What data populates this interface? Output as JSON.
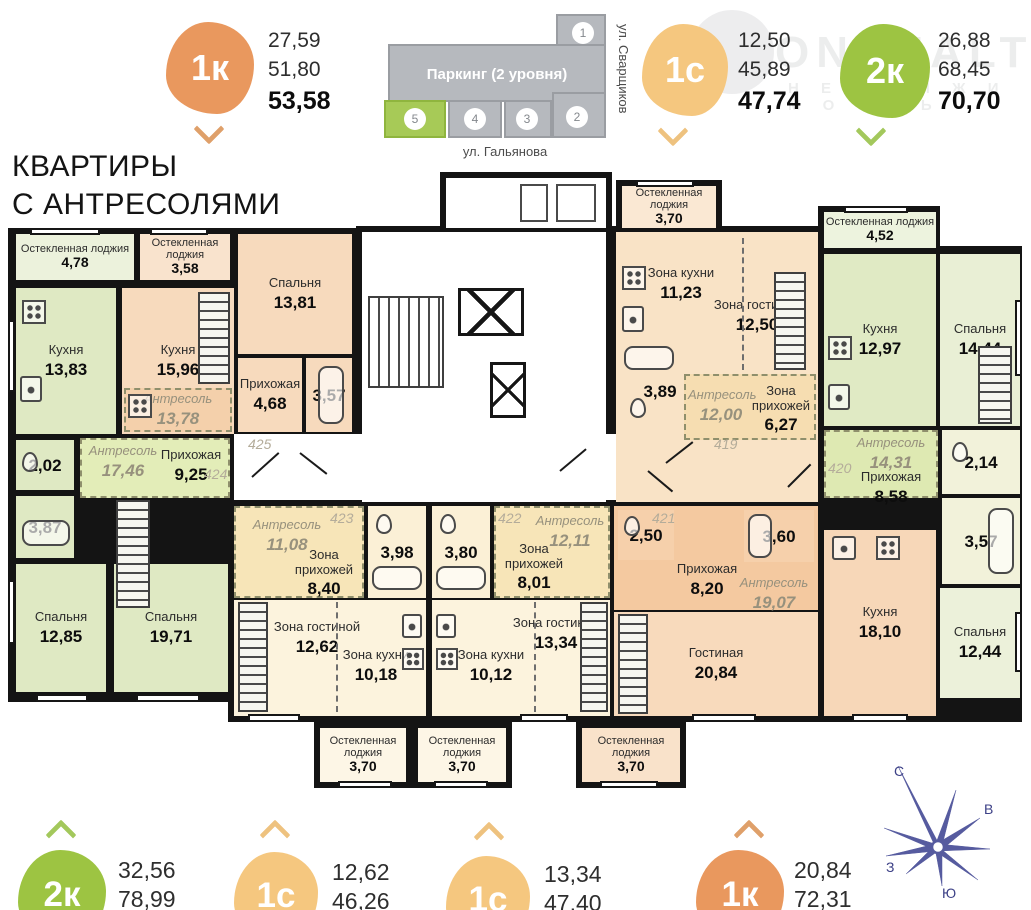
{
  "palette": {
    "badge_orange": "#e9985e",
    "badge_light_orange": "#f5c77f",
    "badge_green": "#9dc442",
    "compass_blue": "#565b9f",
    "wall": "#141414"
  },
  "title": {
    "line1": "КВАРТИРЫ",
    "line2": "С АНТРЕСОЛЯМИ"
  },
  "header": {
    "badges": [
      {
        "label": "1к",
        "v1": "27,59",
        "v2": "51,80",
        "total": "53,58"
      },
      {
        "label": "1с",
        "v1": "12,50",
        "v2": "45,89",
        "total": "47,74"
      },
      {
        "label": "2к",
        "v1": "26,88",
        "v2": "68,45",
        "total": "70,70"
      }
    ],
    "site_plan": {
      "parking": "Паркинг (2 уровня)",
      "street_right": "ул. Сварщиков",
      "street_bottom": "ул. Гальянова",
      "blocks": [
        "1",
        "2",
        "3",
        "4",
        "5"
      ],
      "highlighted": "5"
    },
    "watermark": {
      "line1": "ONREALT",
      "line2": "Н Е Д В И Ж И М О С Т Ь"
    }
  },
  "plan": {
    "apt424": {
      "num": "424",
      "loggia_name": "Остекленная лоджия",
      "loggia_area": "4,78",
      "kitchen_name": "Кухня",
      "kitchen_area": "13,83",
      "wc_area": "2,02",
      "bath_area": "3,87",
      "antresol_name": "Антресоль",
      "antresol_area": "17,46",
      "hall_name": "Прихожая",
      "hall_area": "9,25",
      "bedroom1_name": "Спальня",
      "bedroom1_area": "12,85",
      "bedroom2_name": "Спальня",
      "bedroom2_area": "19,71"
    },
    "apt425": {
      "num": "425",
      "loggia_name": "Остекленная лоджия",
      "loggia_area": "3,58",
      "kitchen_name": "Кухня",
      "kitchen_area": "15,96",
      "antresol_name": "Антресоль",
      "antresol_area": "13,78",
      "bedroom_name": "Спальня",
      "bedroom_area": "13,81",
      "hall_name": "Прихожая",
      "hall_area": "4,68",
      "bath_area": "3,57"
    },
    "apt419": {
      "num": "419",
      "loggia_name": "Остекленная лоджия",
      "loggia_area": "3,70",
      "kitchen_zone_name": "Зона кухни",
      "kitchen_zone_area": "11,23",
      "living_zone_name": "Зона гостиной",
      "living_zone_area": "12,50",
      "bath_area": "3,89",
      "antresol_name": "Антресоль",
      "antresol_area": "12,00",
      "hall_zone_name": "Зона прихожей",
      "hall_zone_area": "6,27"
    },
    "apt420": {
      "num": "420",
      "loggia_name": "Остекленная лоджия",
      "loggia_area": "4,52",
      "kitchen_name": "Кухня",
      "kitchen_area": "12,97",
      "bedroom_name": "Спальня",
      "bedroom_area": "14,44",
      "antresol_name": "Антресоль",
      "antresol_area": "14,31",
      "hall_name": "Прихожая",
      "hall_area": "8,58",
      "wc_area": "2,14",
      "bath_area": "3,57",
      "bedroom2_name": "Спальня",
      "bedroom2_area": "12,44"
    },
    "apt423": {
      "num": "423",
      "antresol_name": "Антресоль",
      "antresol_area": "11,08",
      "hall_zone_name": "Зона прихожей",
      "hall_zone_area": "8,40",
      "bath_area": "3,98",
      "living_zone_name": "Зона гостиной",
      "living_zone_area": "12,62",
      "kitchen_zone_name": "Зона кухни",
      "kitchen_zone_area": "10,18",
      "loggia_name": "Остекленная лоджия",
      "loggia_area": "3,70"
    },
    "apt422": {
      "num": "422",
      "bath_area": "3,80",
      "hall_zone_name": "Зона прихожей",
      "hall_zone_area": "8,01",
      "antresol_name": "Антресоль",
      "antresol_area": "12,11",
      "kitchen_zone_name": "Зона кухни",
      "kitchen_zone_area": "10,12",
      "living_zone_name": "Зона гостиной",
      "living_zone_area": "13,34",
      "loggia_name": "Остекленная лоджия",
      "loggia_area": "3,70"
    },
    "apt421": {
      "num": "421",
      "wc_area": "2,50",
      "bath_area": "3,60",
      "hall_name": "Прихожая",
      "hall_area": "8,20",
      "antresol_name": "Антресоль",
      "antresol_area": "19,07",
      "living_name": "Гостиная",
      "living_area": "20,84",
      "loggia_name": "Остекленная лоджия",
      "loggia_area": "3,70"
    },
    "kitchen_right": {
      "name": "Кухня",
      "area": "18,10"
    }
  },
  "footer": {
    "badges": [
      {
        "label": "2к",
        "v1": "32,56",
        "v2": "78,99"
      },
      {
        "label": "1с",
        "v1": "12,62",
        "v2": "46,26"
      },
      {
        "label": "1с",
        "v1": "13,34",
        "v2": "47,40"
      },
      {
        "label": "1к",
        "v1": "20,84",
        "v2": "72,31"
      }
    ],
    "compass": {
      "n": "С",
      "e": "В",
      "s": "Ю",
      "w": "З"
    }
  }
}
